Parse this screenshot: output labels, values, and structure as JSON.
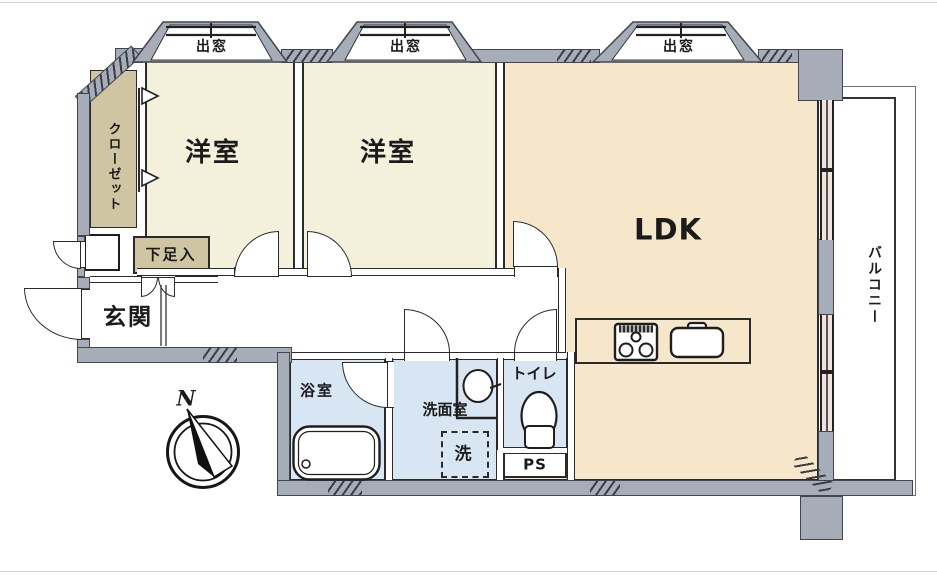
{
  "floor_plan": {
    "bay_windows": [
      {
        "label": "出窓"
      },
      {
        "label": "出窓"
      },
      {
        "label": "出窓"
      }
    ],
    "rooms": {
      "western_room_1": {
        "label": "洋室"
      },
      "western_room_2": {
        "label": "洋室"
      },
      "ldk": {
        "label": "LDK"
      },
      "closet": {
        "label": "クローゼット"
      },
      "shoe_cabinet": {
        "label": "下足入"
      },
      "entrance": {
        "label": "玄関"
      },
      "bathroom": {
        "label": "浴室"
      },
      "washroom": {
        "label": "洗面室"
      },
      "laundry_space": {
        "label": "洗"
      },
      "toilet": {
        "label": "トイレ"
      },
      "pipe_space": {
        "label": "PS"
      },
      "balcony": {
        "label": "バルコニー"
      }
    },
    "compass": {
      "north_label": "N"
    },
    "icons": [
      "compass-icon",
      "bathtub-icon",
      "toilet-icon",
      "washbasin-icon",
      "stove-icon",
      "kitchen-sink-icon",
      "closet-door-arrow-icon",
      "door-swing-icon",
      "bay-window-icon"
    ],
    "colors": {
      "wall": "#a7adb8",
      "outline": "#2a2a2a",
      "western_room": "#f3f0dc",
      "ldk": "#f6e7ca",
      "wet_area": "#d7e6f2",
      "storage": "#cfc5a2",
      "window_tint": "#f2e3dc"
    }
  }
}
